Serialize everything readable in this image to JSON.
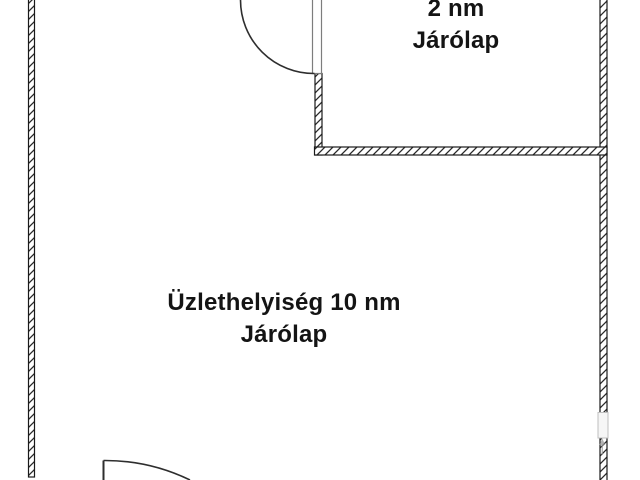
{
  "labels": {
    "small_room": {
      "line1": "2 nm",
      "line2": "Járólap"
    },
    "main_room": {
      "line1": "Üzlethelyiség 10 nm",
      "line2": "Járólap"
    }
  },
  "colors": {
    "background": "#ffffff",
    "wall_line": "#1a1a1a",
    "wall_hatch": "#2a2a2a",
    "door_line": "#2e2e2e",
    "door_leaf_outline": "#7d7d7d",
    "window_fill": "#f6f6f6",
    "window_border": "#bfbfbf",
    "marker": "#9a9a9a",
    "text": "#141414"
  }
}
